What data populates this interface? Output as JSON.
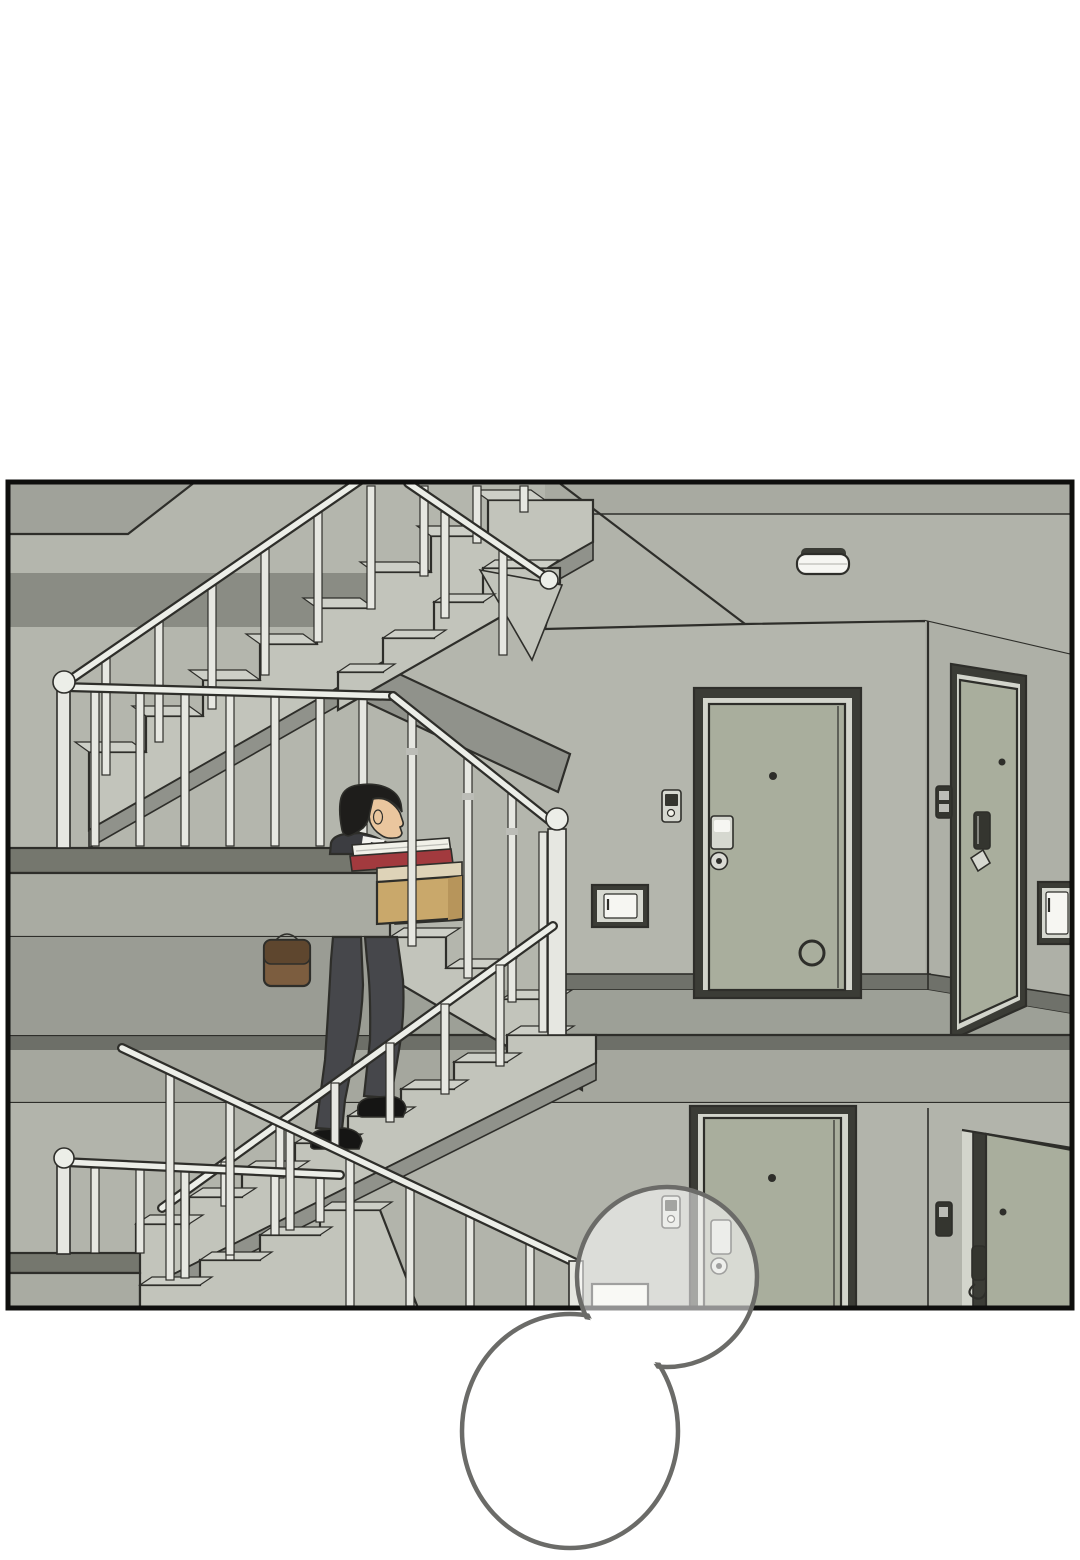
{
  "meta": {
    "description": "Webtoon comic panel: a man in a suit carrying a cardboard box with files climbs an apartment stairwell; sage-green apartment doors line the hallway; two empty speech bubbles overlap the bottom of the panel",
    "panel_count": "1",
    "text_content_visible": ""
  },
  "scene": {
    "objects": [
      "stairwell-upper-flight",
      "stairwell-landing",
      "stairwell-lower-flight",
      "handrails-and-balusters",
      "mid-landing-slab",
      "floor-slab",
      "hallway-ceiling",
      "ceiling-lamp",
      "apartment-door-front",
      "apartment-door-side",
      "doorbell",
      "door-keypad",
      "door-lock",
      "door-pull",
      "wall-utility-box",
      "lower-floor-hallway",
      "lower-apartment-door-front",
      "lower-apartment-door-side",
      "man-carrying-box",
      "cardboard-box",
      "stack-of-files",
      "shoulder-bag",
      "speech-bubble-small",
      "speech-bubble-large"
    ]
  },
  "palette": {
    "page_bg": "#ffffff",
    "line": "#2e2e2a",
    "panel_border": "#0f0f0e",
    "wall": "#b4b6ad",
    "wall_top_strip": "#a8aaa1",
    "ceiling": "#b1b3aa",
    "wall_right": "#aeb0a7",
    "wall_lower": "#b2b4ab",
    "wall_dark_band": "#8a8c84",
    "corner_piece": "#a0a29a",
    "understair_shadow": "#9a9c94",
    "door": "#a9ae9d",
    "door_frame": "#3b3c36",
    "door_jamb": "#d3d5cc",
    "keypad_light": "#d6d8d0",
    "keypad_dark": "#34352f",
    "lock": "#dadbd4",
    "floor": "#9da097",
    "baseboard": "#6f716a",
    "slab_top": "#6d6f68",
    "slab_face": "#a5a79e",
    "landing_top": "#75776e",
    "landing_face": "#a9aba2",
    "step_fill": "#c2c4bb",
    "step_tread": "#cdcfc7",
    "stringer": "#90928b",
    "rail_fill": "#eceee8",
    "baluster": "#e6e7e1",
    "metal_shadow": "#bcbdb7",
    "lamp_top": "#f6f6f2",
    "hair": "#1e1d1b",
    "skin": "#eac69e",
    "shirt": "#f3f3ef",
    "tie": "#2b2c30",
    "suit": "#3c3d41",
    "trousers": "#46474b",
    "shoes": "#151514",
    "bag": "#7c5d3f",
    "bag_dark": "#5e462e",
    "box": "#c9a86b",
    "box_side": "#b7955b",
    "box_lip": "#ded3b8",
    "file_red": "#a23a3e",
    "paper": "#f1f1e9",
    "bubble_stroke": "#6b6b68",
    "bubble_glass": "rgba(255,255,255,0.55)",
    "bubble_fill": "#ffffff"
  }
}
